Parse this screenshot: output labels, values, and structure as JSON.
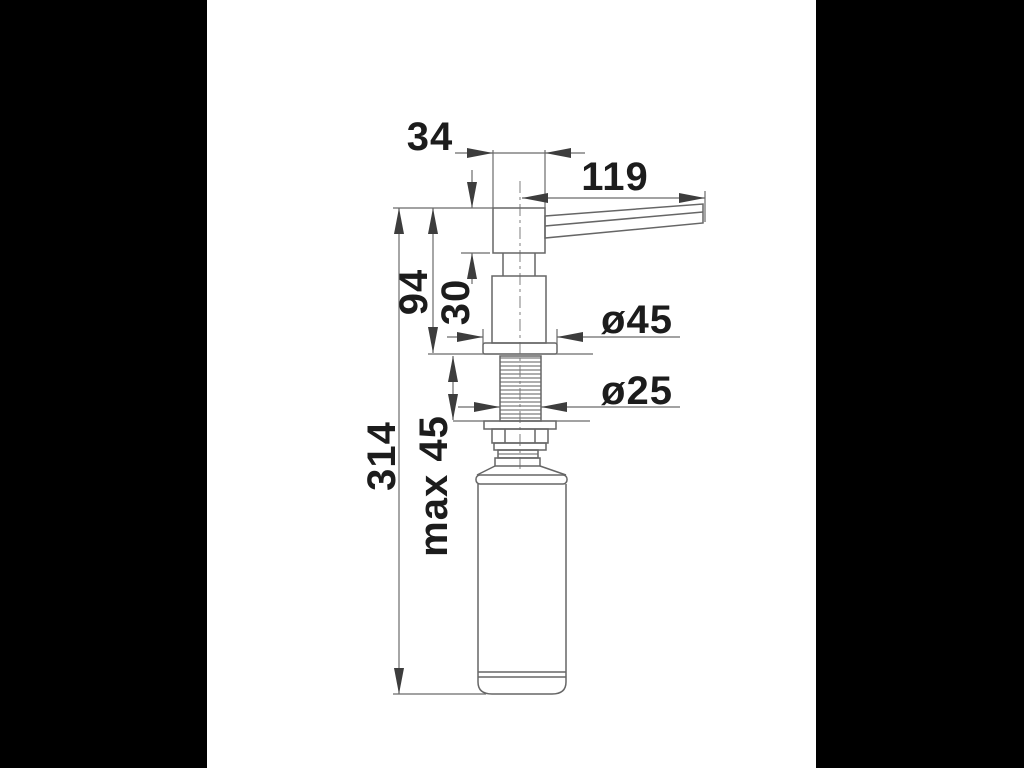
{
  "meta": {
    "description": "Technical dimension drawing (side view) of a built-in kitchen soap dispenser with pump head, spout lever, mounting flange, threaded shank, fixing nut and soap bottle",
    "units": "mm"
  },
  "colors": {
    "letterbox": "#000000",
    "paper": "#ffffff",
    "line": "#666666",
    "arrow": "#3d3d3d",
    "text": "#1c1c1c"
  },
  "labels": {
    "head_width": "34",
    "spout_projection": "119",
    "height_above_counter": "94",
    "head_height": "30",
    "flange_diameter": "ø45",
    "shank_diameter": "ø25",
    "max_counter_thickness": "max 45",
    "total_height": "314"
  }
}
